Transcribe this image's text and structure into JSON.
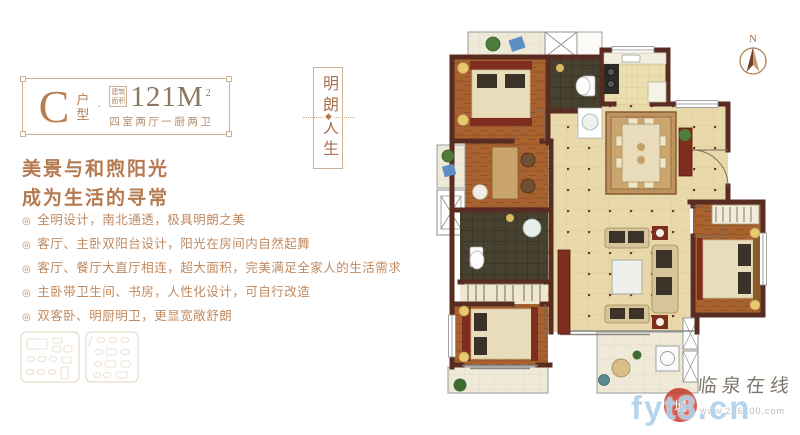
{
  "plaque": {
    "unit_letter": "C",
    "unit_label_char1": "户",
    "unit_label_char2": "型",
    "divider_dot": "·",
    "area_prefix_line1": "建筑",
    "area_prefix_line2": "面积",
    "area_value": "121M",
    "area_superscript": "2",
    "rooms_summary": "四室两厅一厨两卫"
  },
  "banner": {
    "word_top": "明朗",
    "word_bottom": "人生",
    "divider_glyph": "◆"
  },
  "headline": {
    "line1": "美景与和煦阳光",
    "line2": "成为生活的寻常"
  },
  "features": {
    "marker": "◎",
    "items": [
      "全明设计，南北通透，极具明朗之美",
      "客厅、主卧双阳台设计，阳光在房间内自然起舞",
      "客厅、餐厅大直厅相连，超大面积，完美满足全家人的生活需求",
      "主卧带卫生间、书房，人性化设计，可自行改造",
      "双客卧、明厨明卫，更显宽敞舒朗"
    ]
  },
  "floorplan": {
    "compass_label": "N"
  },
  "watermark": {
    "seal_char": "城",
    "site_name": "临泉在线",
    "domain_large": "fyt8.cn",
    "domain_small": "www.236400.com"
  },
  "colors": {
    "accent_copper": "#b5794f",
    "frame_tan": "#cdb394",
    "wall_brown": "#582c20",
    "wood_floor": "#a7622f",
    "tile_tan": "#e9d8a9",
    "tile_dark": "#474130",
    "rug_red": "#7e2d1e",
    "watermark_blue": "#aed2ec",
    "seal_red": "#c43d2e"
  }
}
